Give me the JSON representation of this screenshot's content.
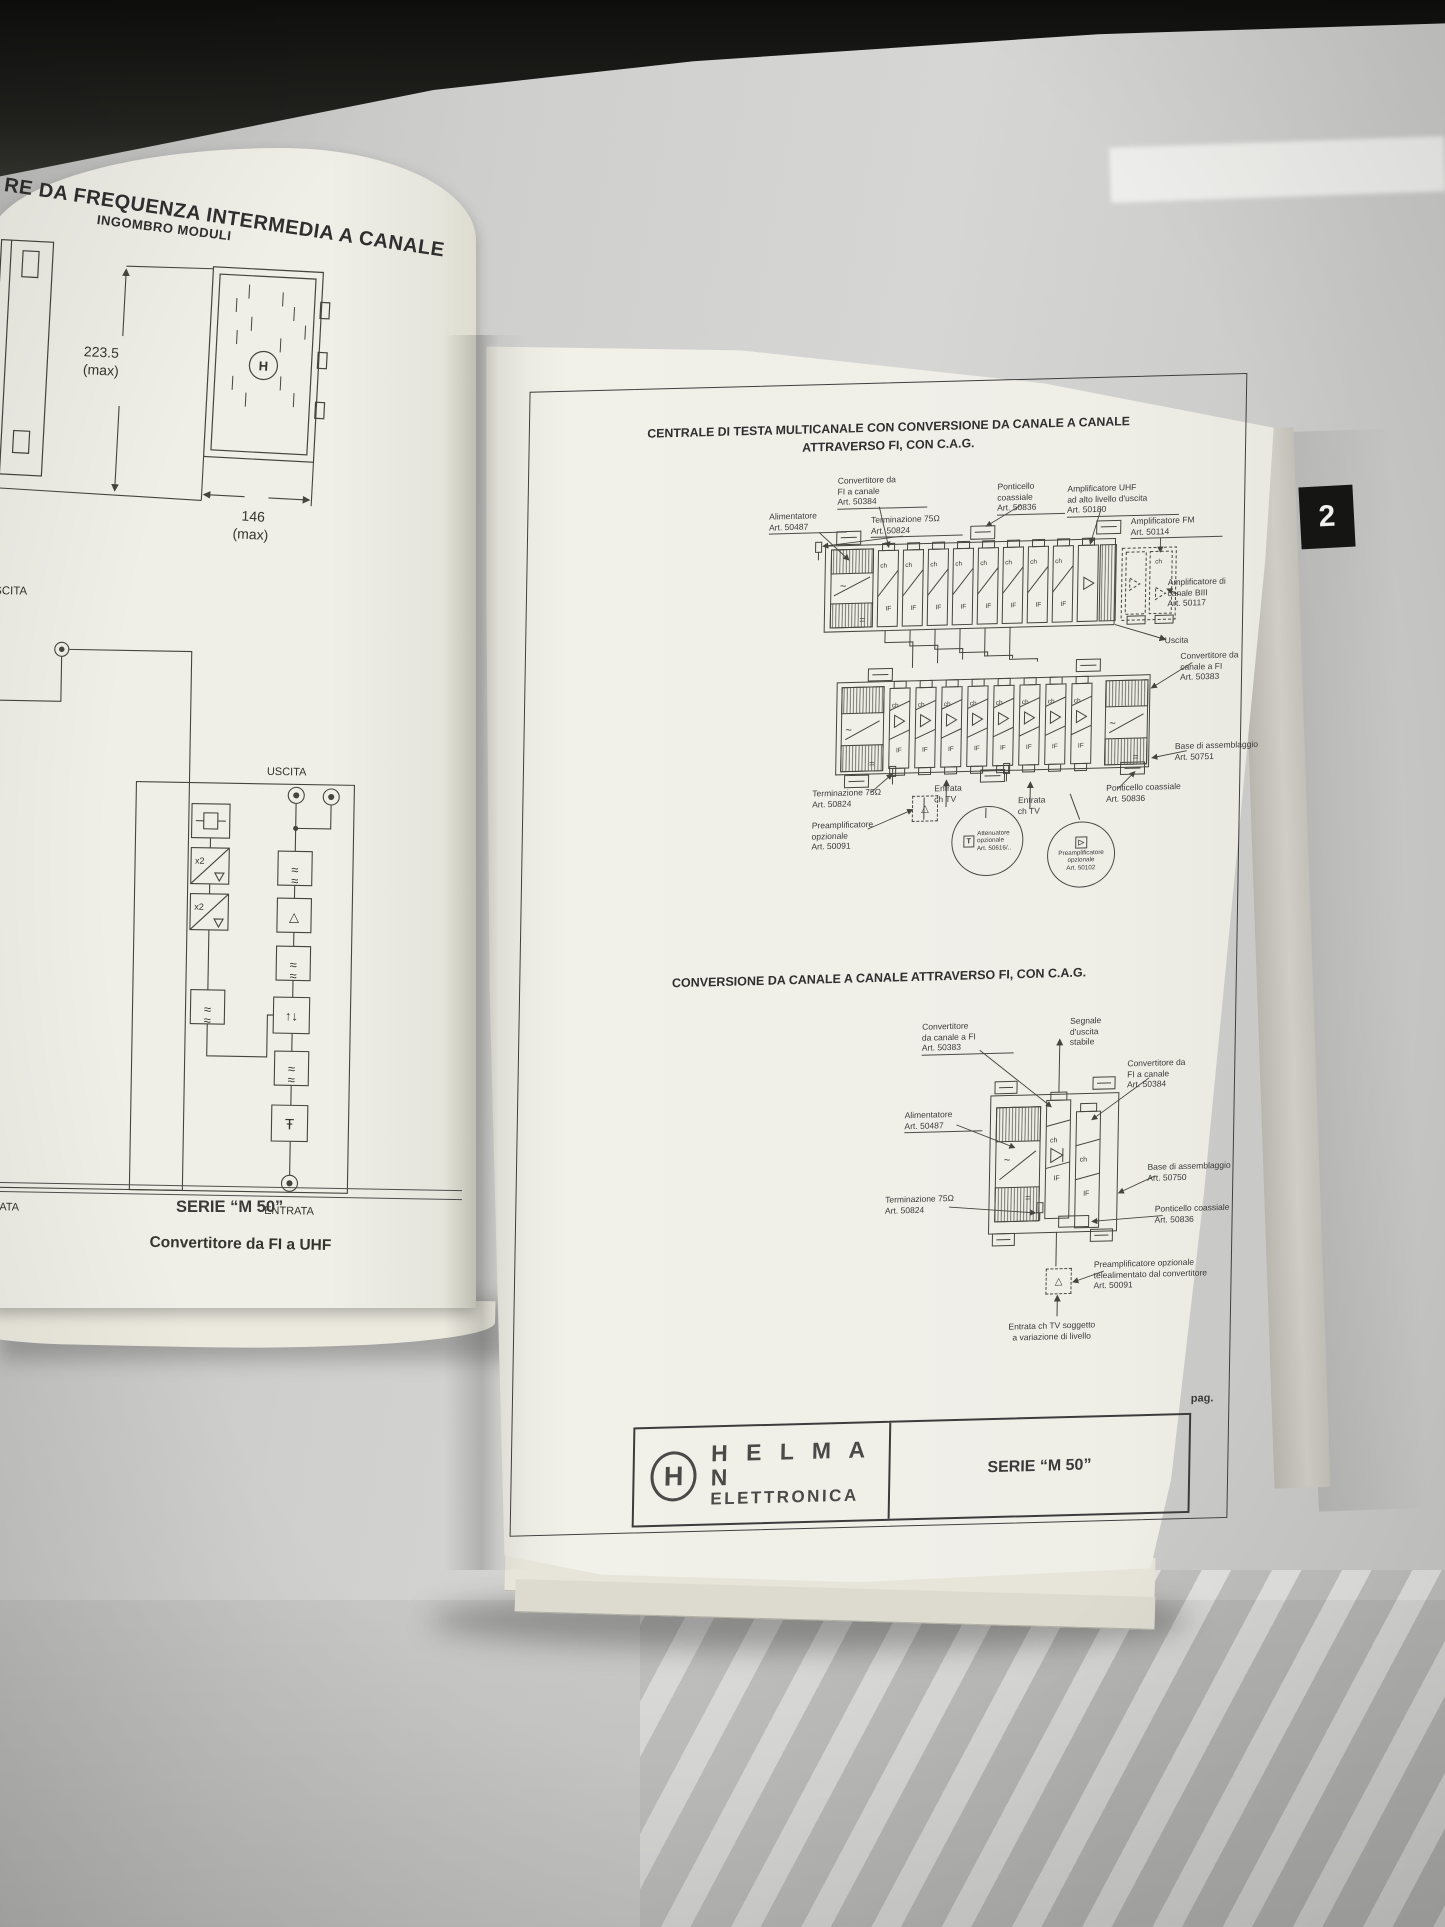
{
  "left_page": {
    "title_partial": "RE DA FREQUENZA INTERMEDIA A CANALE",
    "subtitle": "INGOMBRO MODULI",
    "dims": {
      "height_value": "223.5",
      "height_max": "(max)",
      "width_value": "146",
      "width_max": "(max)"
    },
    "logo_letter": "H",
    "diagram": {
      "uscita_partial": "USCITA",
      "uscita": "USCITA",
      "entrata": "ENTRATA",
      "entrata_partial": "ENTRATA",
      "caption_partial": "F",
      "x2": "x2",
      "caption": "Convertitore da FI a UHF"
    },
    "footer_series": "SERIE “M 50”"
  },
  "right_page": {
    "tab": "2",
    "section1": {
      "title_line1": "CENTRALE DI TESTA MULTICANALE CON CONVERSIONE DA CANALE A CANALE",
      "title_line2": "ATTRAVERSO FI, CON C.A.G.",
      "labels": {
        "convertitore_fi_canale": "Convertitore da\nFI a canale\nArt. 50384",
        "alimentatore": "Alimentatore\nArt. 50487",
        "terminazione": "Terminazione 75Ω\nArt. 50824",
        "ponticello": "Ponticello\ncoassiale\nArt. 50836",
        "amplificatore_uhf": "Amplificatore UHF\nad alto livello d'uscita\nArt. 50180",
        "amplificatore_fm": "Amplificatore FM\nArt. 50114",
        "amplificatore_biii": "Amplificatore di\ncanale BIII\nArt. 50117",
        "uscita": "Uscita",
        "convertitore_canale_fi": "Convertitore da\ncanale a FI\nArt. 50383",
        "base_assemblaggio": "Base di assemblaggio\nArt. 50751",
        "ponticello_2": "Ponticello coassiale\nArt. 50836",
        "terminazione_2": "Terminazione 75Ω\nArt. 50824",
        "entrata_1": "Entrata\nch TV",
        "entrata_2": "Entrata\nch TV",
        "preamplificatore_1": "Preamplificatore\nopzionale\nArt. 50091",
        "attenuatore": "Attenuatore\nopzionale\nArt. 50616/..",
        "preamplificatore_2": "Preamplificatore\nopzionale\nArt. 50102"
      },
      "module": {
        "ch": "ch",
        "if_label": "IF"
      }
    },
    "section2": {
      "title": "CONVERSIONE DA CANALE A CANALE ATTRAVERSO FI, CON C.A.G.",
      "labels": {
        "convertitore_canale_fi": "Convertitore\nda canale a FI\nArt. 50383",
        "segnale_uscita": "Segnale\nd'uscita\nstabile",
        "convertitore_fi_canale": "Convertitore da\nFI a canale\nArt. 50384",
        "alimentatore": "Alimentatore\nArt. 50487",
        "base_assemblaggio": "Base di assemblaggio\nArt. 50750",
        "terminazione": "Terminazione 75Ω\nArt. 50824",
        "ponticello": "Ponticello coassiale\nArt. 50836",
        "preamplificatore": "Preamplificatore opzionale\ntelealimentato dal convertitore\nArt. 50091",
        "entrata": "Entrata ch TV soggetto\na variazione di livello"
      },
      "module": {
        "ch": "ch",
        "if_label": "IF"
      }
    },
    "pag_label": "pag.",
    "footer": {
      "logo_letter": "H",
      "brand_line1": "H E L M A N",
      "brand_line2": "ELETTRONICA",
      "series": "SERIE “M 50”"
    }
  },
  "icons": {
    "approx": "≈",
    "triangle_up": "△",
    "triangle_right": "▷",
    "agc_arrows": "↑↓",
    "trap": "Ŧ",
    "tilde": "~",
    "equals": "=",
    "attenuator": "T"
  }
}
